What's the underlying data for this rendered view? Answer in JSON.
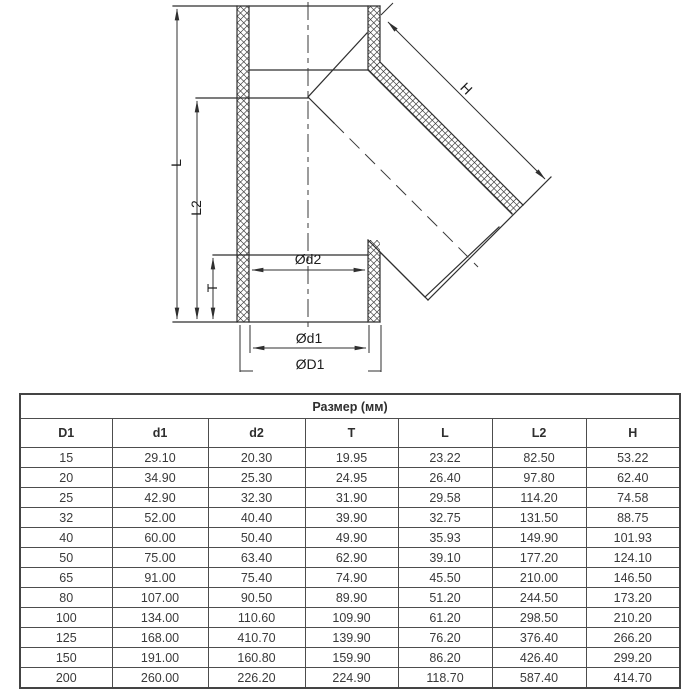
{
  "drawing": {
    "labels": {
      "L": "L",
      "L2": "L2",
      "T": "T",
      "H": "H",
      "d2": "Ød2",
      "d1": "Ød1",
      "D1": "ØD1"
    },
    "line_color": "#2f2f2f"
  },
  "table": {
    "title": "Размер (мм)",
    "columns": [
      "D1",
      "d1",
      "d2",
      "T",
      "L",
      "L2",
      "H"
    ],
    "rows": [
      [
        "15",
        "29.10",
        "20.30",
        "19.95",
        "23.22",
        "82.50",
        "53.22"
      ],
      [
        "20",
        "34.90",
        "25.30",
        "24.95",
        "26.40",
        "97.80",
        "62.40"
      ],
      [
        "25",
        "42.90",
        "32.30",
        "31.90",
        "29.58",
        "114.20",
        "74.58"
      ],
      [
        "32",
        "52.00",
        "40.40",
        "39.90",
        "32.75",
        "131.50",
        "88.75"
      ],
      [
        "40",
        "60.00",
        "50.40",
        "49.90",
        "35.93",
        "149.90",
        "101.93"
      ],
      [
        "50",
        "75.00",
        "63.40",
        "62.90",
        "39.10",
        "177.20",
        "124.10"
      ],
      [
        "65",
        "91.00",
        "75.40",
        "74.90",
        "45.50",
        "210.00",
        "146.50"
      ],
      [
        "80",
        "107.00",
        "90.50",
        "89.90",
        "51.20",
        "244.50",
        "173.20"
      ],
      [
        "100",
        "134.00",
        "110.60",
        "109.90",
        "61.20",
        "298.50",
        "210.20"
      ],
      [
        "125",
        "168.00",
        "410.70",
        "139.90",
        "76.20",
        "376.40",
        "266.20"
      ],
      [
        "150",
        "191.00",
        "160.80",
        "159.90",
        "86.20",
        "426.40",
        "299.20"
      ],
      [
        "200",
        "260.00",
        "226.20",
        "224.90",
        "118.70",
        "587.40",
        "414.70"
      ]
    ],
    "border_color": "#4d4d4d"
  }
}
